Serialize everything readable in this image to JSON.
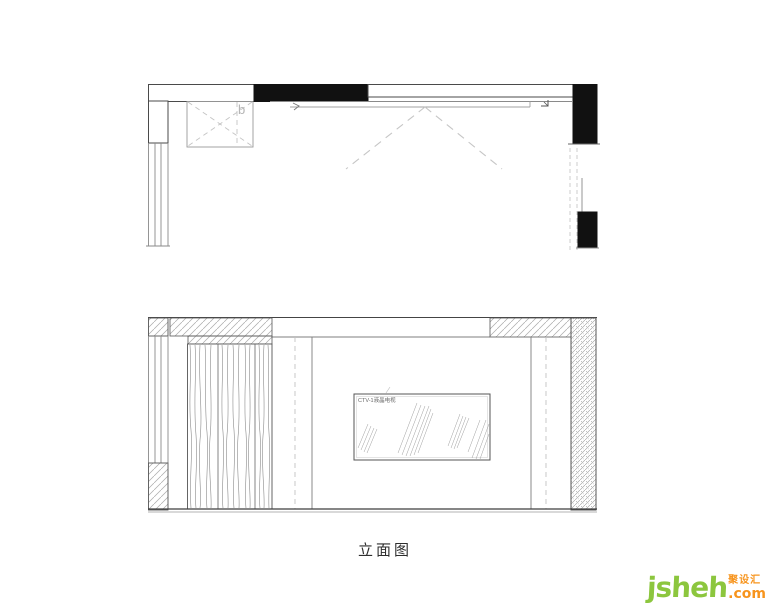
{
  "page": {
    "background": "#ffffff"
  },
  "plan": {
    "cabinet_label": "b"
  },
  "elevation": {
    "tv_label": "CTV-1液晶电视",
    "caption": "立面图"
  },
  "watermark": {
    "name": "jsheh",
    "suffix": ".com",
    "cjk": "聚设汇",
    "green": "#8cc63e",
    "orange": "#f7941d"
  },
  "colors": {
    "line": "#3f3f3f",
    "wall_fill": "#0d0d0d",
    "dash": "#c0c0c0",
    "hatch": "#9a9a9a",
    "grain": "#8a8a8a"
  }
}
